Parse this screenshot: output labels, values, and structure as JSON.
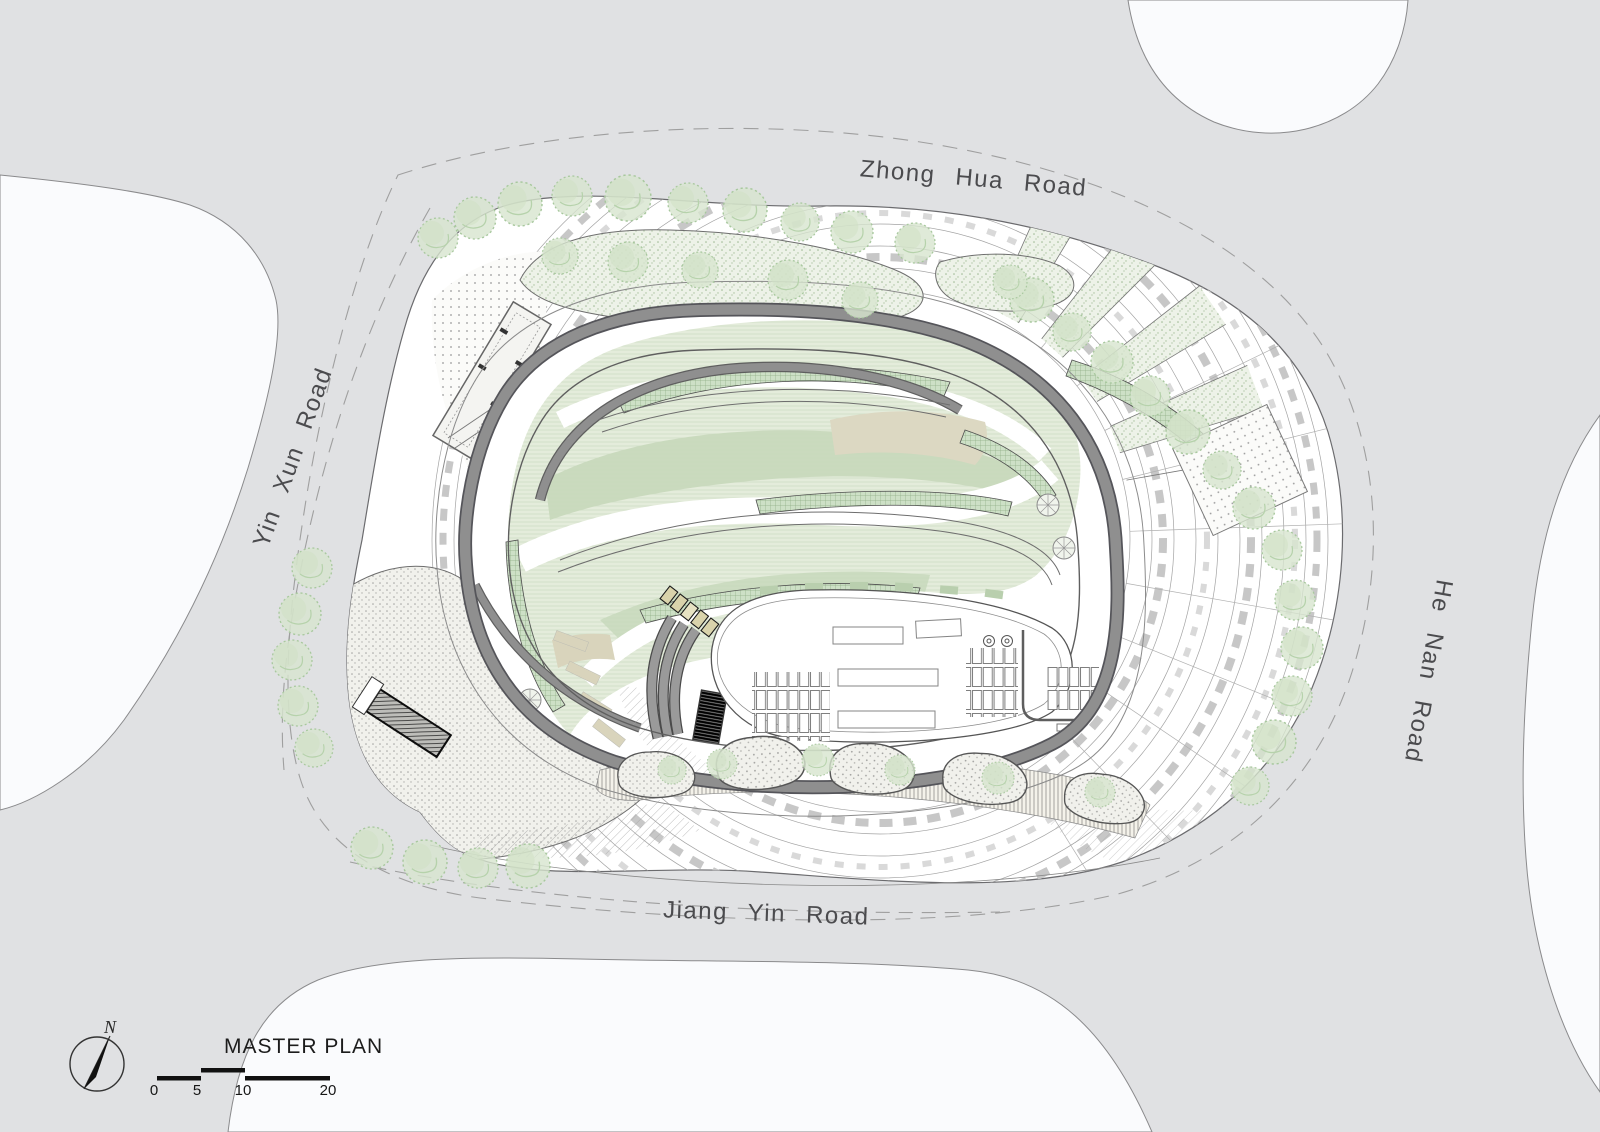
{
  "plan": {
    "kind": "architectural master plan drawing",
    "roads": {
      "top": "Zhong Hua Road",
      "left": "Yin Xun Road",
      "right": "He Nan Road",
      "bottom": "Jiang Yin Road"
    },
    "legend": {
      "title": "MASTER PLAN",
      "north_label": "N",
      "scale_ticks": [
        "0",
        "5",
        "10",
        "20"
      ]
    },
    "colors": {
      "road_gray": "#e0e1e3",
      "parcel_white": "#fafbfd",
      "site_white": "#ffffff",
      "building_band_gray": "#8f8f8f",
      "building_edge_dark": "#55555a",
      "outline": "#6b6b6e",
      "green_light": "#e2ead9",
      "green_mid": "#c6d8ba",
      "green_planter": "#cde0c6",
      "khaki": "#dcd8c2",
      "tree_green": "#d7e5ce",
      "label_text": "#4b4b4e"
    }
  }
}
